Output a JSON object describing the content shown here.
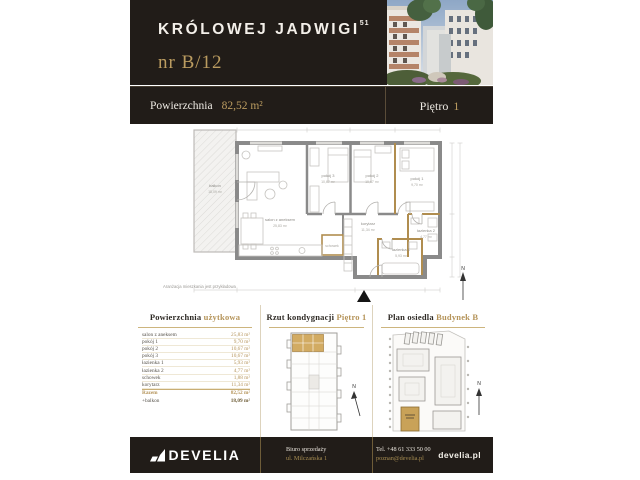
{
  "header": {
    "title": "KRÓLOWEJ JADWIGI",
    "title_sup": "51",
    "unit": "nr B/12",
    "area_label": "Powierzchnia",
    "area_value": "82,52 m²",
    "floor_label": "Piętro",
    "floor_value": "1"
  },
  "plan": {
    "disclaimer": "Aranżacja mieszkania jest przykładowa",
    "north_label": "N",
    "rooms": {
      "balkon": {
        "name": "balkon",
        "area": "18,09 m²"
      },
      "salon": {
        "name": "salon z aneksem",
        "area": "25,83 m²"
      },
      "pokoj3": {
        "name": "pokój 3",
        "area": "10,67 m²"
      },
      "pokoj2": {
        "name": "pokój 2",
        "area": "10,67 m²"
      },
      "pokoj1": {
        "name": "pokój 1",
        "area": "9,70 m²"
      },
      "korytarz": {
        "name": "korytarz",
        "area": "11,34 m²"
      },
      "lazienka1": {
        "name": "łazienka 1",
        "area": "5,93 m²"
      },
      "lazienka2": {
        "name": "łazienka 2",
        "area": "4,77 m²"
      },
      "schowek": {
        "name": "schowek"
      }
    }
  },
  "table": {
    "heading": "Powierzchnia",
    "heading_accent": "użytkowa",
    "rows": [
      {
        "label": "salon z aneksem",
        "value": "25,83 m²"
      },
      {
        "label": "pokój 1",
        "value": "9,70 m²"
      },
      {
        "label": "pokój 2",
        "value": "10,67 m²"
      },
      {
        "label": "pokój 3",
        "value": "10,67 m²"
      },
      {
        "label": "łazienka 1",
        "value": "5,93 m²"
      },
      {
        "label": "łazienka 2",
        "value": "4,77 m²"
      },
      {
        "label": "schowek",
        "value": "1,88 m²"
      },
      {
        "label": "korytarz",
        "value": "11,34 m²"
      }
    ],
    "total": {
      "label": "Razem",
      "value": "82,52 m²"
    },
    "balcony": {
      "label": "+balkon",
      "value": "18,09 m²"
    }
  },
  "sections": {
    "floorplate": {
      "heading": "Rzut kondygnacji",
      "accent": "Piętro 1",
      "north_label": "N"
    },
    "siteplan": {
      "heading": "Plan osiedla",
      "accent": "Budynek B",
      "north_label": "N"
    }
  },
  "footer": {
    "brand": "DEVELIA",
    "office_label": "Biuro sprzedaży",
    "office_address": "ul. Milczańska 1",
    "phone": "Tel. +48 61 333 50 00",
    "email": "poznan@develia.pl",
    "website": "develia.pl"
  },
  "colors": {
    "panel": "#211c18",
    "gold": "#bb9c60",
    "wall": "#8a8a8a",
    "gold_wall": "#b08d4f"
  }
}
